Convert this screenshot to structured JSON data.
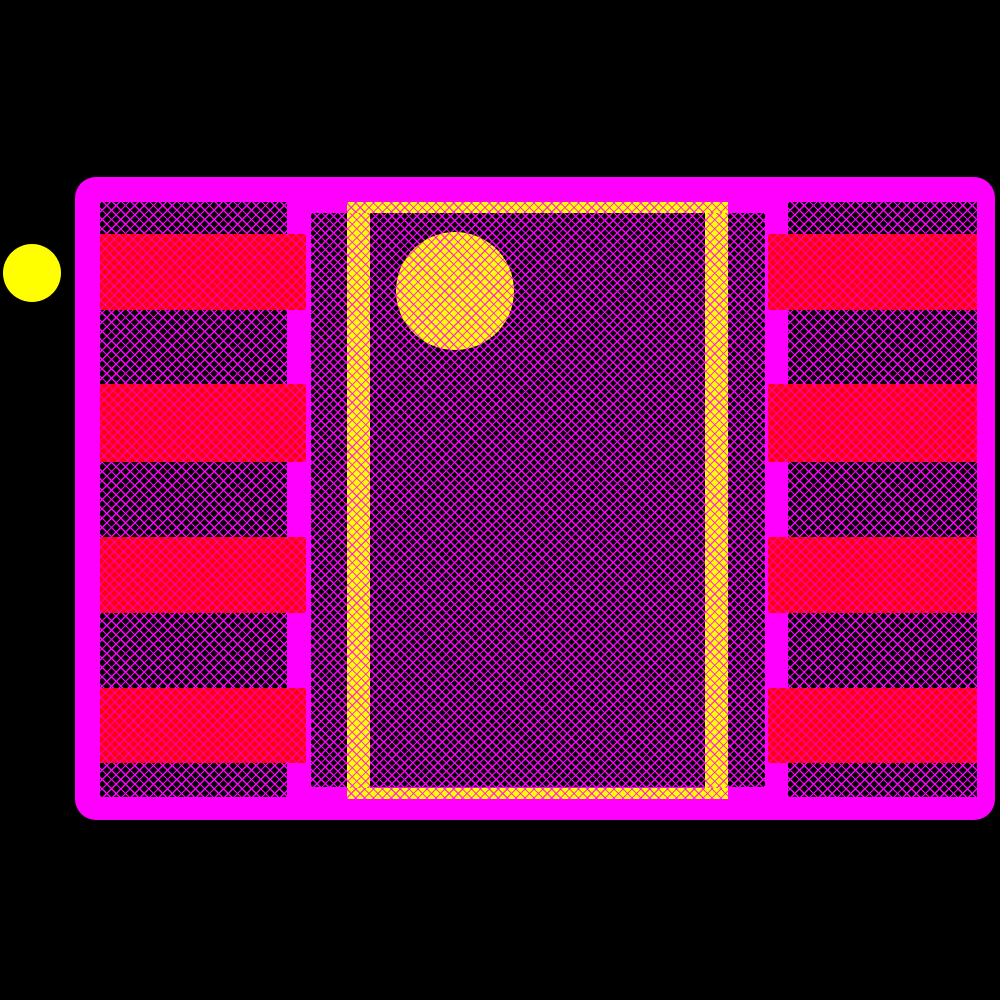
{
  "canvas": {
    "width": 1000,
    "height": 1000,
    "background": "#000000"
  },
  "colors": {
    "background": "#000000",
    "courtyard_magenta": "#ff00ff",
    "hatch_line_magenta": "#ff00ff",
    "dark_region_fill": "#000000",
    "pad_red": "#ff0011",
    "yellow": "#ffff00",
    "pin1_marker_yellow": "#ffff00"
  },
  "footprint": {
    "courtyard": {
      "x": 75,
      "y": 177,
      "width": 920,
      "height": 643,
      "corner_radius": 21
    },
    "pin1_outer_marker": {
      "x": 3,
      "y": 244,
      "diameter": 58
    },
    "left_bank": {
      "x": 100,
      "y": 202,
      "width": 187,
      "height": 595
    },
    "right_bank": {
      "x": 788,
      "y": 202,
      "width": 189,
      "height": 595
    },
    "center_region": {
      "x": 311,
      "y": 213,
      "width": 454,
      "height": 574
    },
    "yellow_frame": {
      "outer": {
        "x": 347,
        "y": 202,
        "width": 381,
        "height": 597
      },
      "side_bar_width": 23,
      "top_bar_height": 11,
      "bottom_bar_height": 11
    },
    "pin1_dot": {
      "x": 396,
      "y": 232,
      "diameter": 118
    },
    "pad_rows": [
      {
        "y": 234,
        "height": 76
      },
      {
        "y": 384,
        "height": 78
      },
      {
        "y": 537,
        "height": 76
      },
      {
        "y": 688,
        "height": 75
      }
    ],
    "left_pads": {
      "x": 100,
      "width": 206
    },
    "right_pads": {
      "x": 768,
      "width": 209
    },
    "pad_count_per_side": 4
  }
}
